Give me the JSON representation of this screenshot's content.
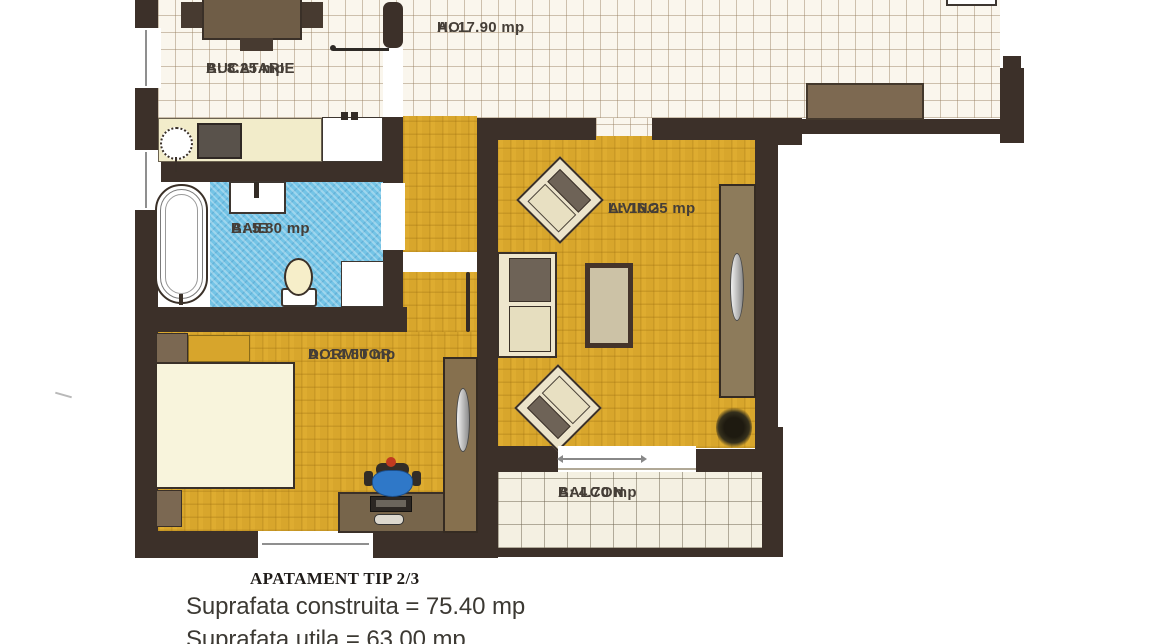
{
  "rooms": [
    {
      "id": "bucatarie",
      "label": "BUCATARIE",
      "area": "A: 8.25 mp"
    },
    {
      "id": "hol",
      "label": "HOL",
      "area": "A: 17.90 mp"
    },
    {
      "id": "baie",
      "label": "BAIE",
      "area": "A: 5.80 mp"
    },
    {
      "id": "living",
      "label": "LIVING",
      "area": "A: 16.25 mp"
    },
    {
      "id": "dormitor",
      "label": "DORMITOR",
      "area": "A: 14.80 mp"
    },
    {
      "id": "balcon",
      "label": "BALCON",
      "area": "A: 4.70 mp"
    }
  ],
  "footer": {
    "title": "APATAMENT TIP 2/3",
    "line1": "Suprafata construita = 75.40 mp",
    "line2": "Suprafata utila = 63.00 mp"
  },
  "palette": {
    "wall": "#3c3029",
    "parquet": "#d8a62c",
    "tile": "#faf6ed",
    "bath_blue": "#74c4e6",
    "wood": "#77654b",
    "cream_counter": "#f2ecca",
    "chair_blue": "#2f78c8",
    "chair_knob_red": "#c03a20"
  }
}
